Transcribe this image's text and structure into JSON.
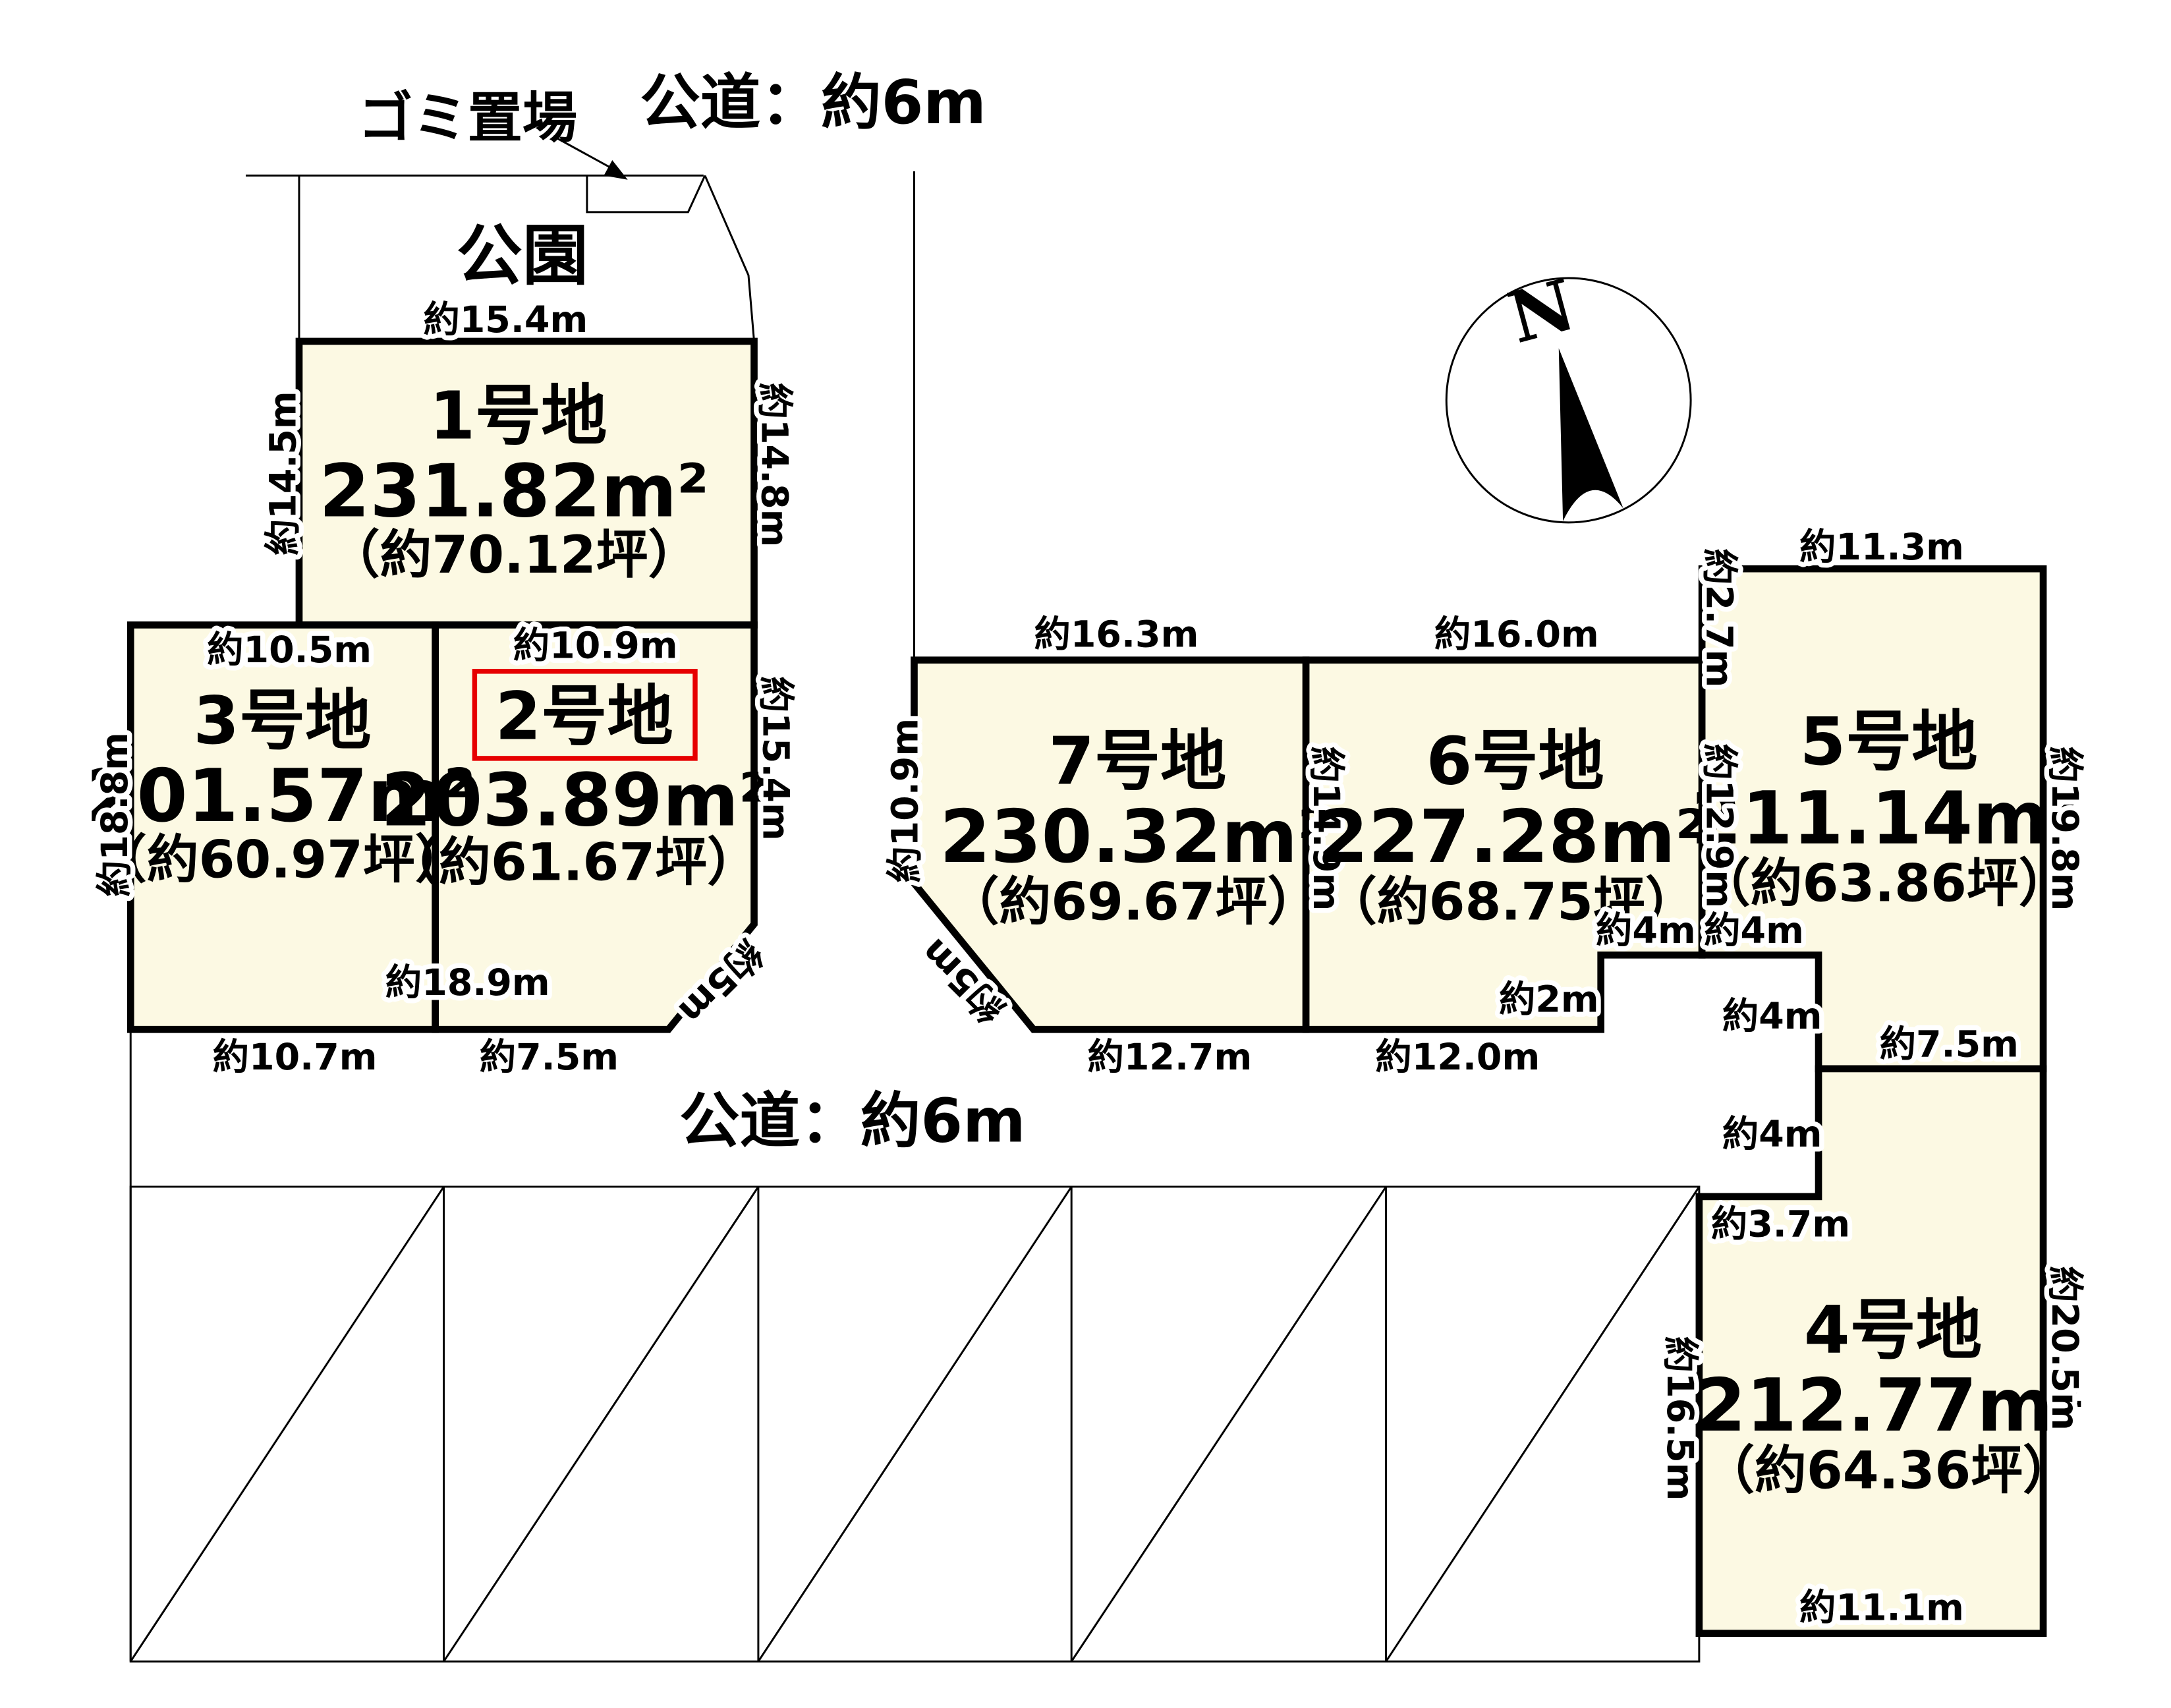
{
  "colors": {
    "background": "#FFFFFF",
    "lot_fill": "#FCF9E3",
    "line": "#000000",
    "highlight_red": "#E60000"
  },
  "annotations": {
    "garbage_label": "ゴミ置場",
    "road_top": "公道：約6m",
    "road_middle": "公道：約6m",
    "park": "公園",
    "north": "N"
  },
  "lots": [
    {
      "name": "1号地",
      "area": "231.82m²",
      "tsubo": "（約70.12坪）",
      "highlighted": false,
      "dims": {
        "top": "約15.4m",
        "left": "約14.5m",
        "right": "約14.8m"
      }
    },
    {
      "name": "2号地",
      "area": "203.89m²",
      "tsubo": "（約61.67坪）",
      "highlighted": true,
      "dims": {
        "top": "約10.9m",
        "right": "約15.4m",
        "divider": "約18.9m",
        "bottom": "約7.5m",
        "corner": "約5m"
      }
    },
    {
      "name": "3号地",
      "area": "201.57m²",
      "tsubo": "（約60.97坪）",
      "highlighted": false,
      "dims": {
        "top": "約10.5m",
        "left": "約18.8m",
        "bottom": "約10.7m"
      }
    },
    {
      "name": "4号地",
      "area": "212.77m²",
      "tsubo": "（約64.36坪）",
      "highlighted": false,
      "dims": {
        "pole_side": "約4m",
        "step_top": "約3.7m",
        "left": "約16.5m",
        "right": "約20.5m",
        "bottom": "約11.1m"
      }
    },
    {
      "name": "5号地",
      "area": "211.14m²",
      "tsubo": "（約63.86坪）",
      "highlighted": false,
      "dims": {
        "top": "約11.3m",
        "left_upper": "約2.7m",
        "left": "約12.9m",
        "right": "約19.8m",
        "pole_top": "約4m",
        "pole_side": "約4m",
        "bottom": "約7.5m"
      }
    },
    {
      "name": "6号地",
      "area": "227.28m²",
      "tsubo": "（約68.75坪）",
      "highlighted": false,
      "dims": {
        "top": "約16.0m",
        "bottom": "約12.0m",
        "step_top": "約4m",
        "step_side": "約2m"
      }
    },
    {
      "name": "7号地",
      "area": "230.32m²",
      "tsubo": "（約69.67坪）",
      "highlighted": false,
      "dims": {
        "top": "約16.3m",
        "left": "約10.9m",
        "right": "約14.9m",
        "bottom": "約12.7m",
        "corner": "約5m"
      }
    }
  ]
}
